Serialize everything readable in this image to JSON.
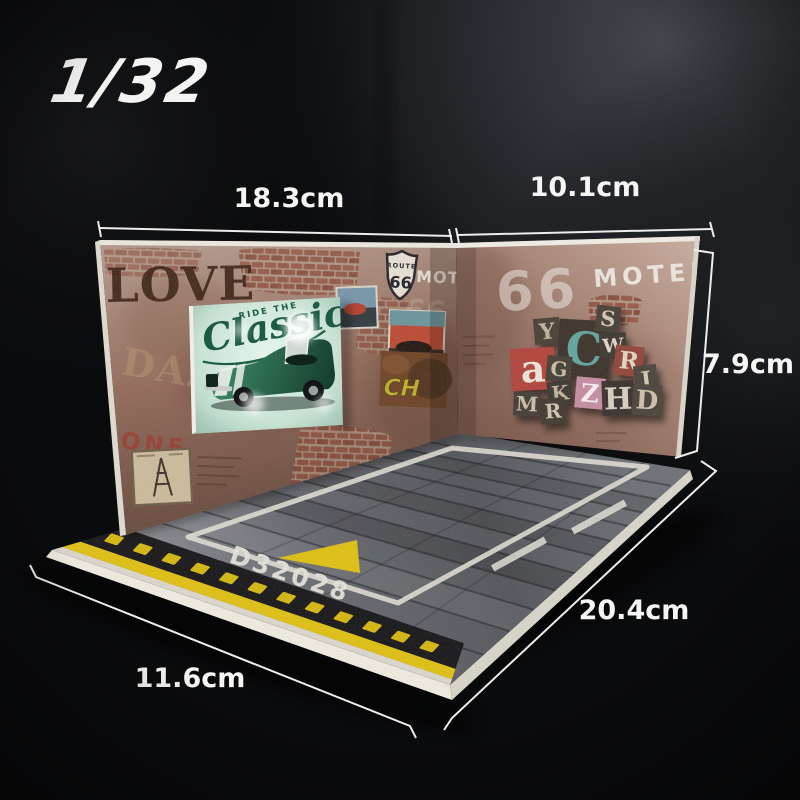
{
  "scale_label": "1/32",
  "dimensions": {
    "left_wall_width": "18.3cm",
    "right_wall_width": "10.1cm",
    "wall_height": "7.9cm",
    "floor_depth": "20.4cm",
    "floor_front": "11.6cm"
  },
  "left_wall": {
    "love_text": "LOVE",
    "daze_text": "DAZE",
    "one_text": "ONE",
    "motel_text": "MOTEL",
    "ghost_number": "66",
    "route_shield": {
      "route": "ROUTE",
      "number": "66"
    },
    "classic_sign": {
      "top_text": "RIDE THE",
      "script_text": "Classic"
    },
    "rust_sign_text": "CH"
  },
  "right_wall": {
    "number": "66",
    "motel_text": "MOTEL",
    "collage": {
      "letters": [
        "Y",
        "C",
        "S",
        "W",
        "R",
        "J",
        "a",
        "G",
        "K",
        "Z",
        "H",
        "D",
        "M",
        "R"
      ]
    }
  },
  "floor": {
    "code": "D32028"
  },
  "icons": {
    "route_shield": "route-66-shield",
    "eiffel_card": "eiffel-tower-postcard",
    "car_sign": "classic-car-lighted-sign",
    "triangle": "direction-triangle",
    "collage": "letterpress-letter-collage"
  },
  "colors": {
    "background": "#0a0b0d",
    "hazard_yellow": "#e3c414",
    "hazard_black": "#17171a",
    "asphalt": "#5c6066",
    "board_edge": "#e7e3d8",
    "left_wall": "#936a5a",
    "right_wall": "#a37f71",
    "sign_mint": "#c3ddcf",
    "sign_green": "#1d5c44",
    "marking_white": "#e6e4da",
    "annotation_white": "#f5f5f3"
  }
}
